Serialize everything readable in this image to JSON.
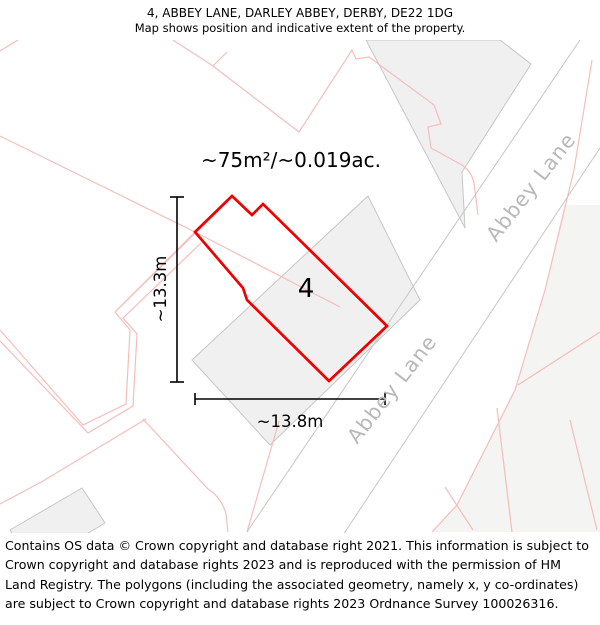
{
  "header": {
    "title": "4, ABBEY LANE, DARLEY ABBEY, DERBY, DE22 1DG",
    "subtitle": "Map shows position and indicative extent of the property."
  },
  "map": {
    "area_label": "~75m²/~0.019ac.",
    "plot_number": "4",
    "width_label": "~13.8m",
    "height_label": "~13.3m",
    "road_labels": {
      "upper": "Abbey Lane",
      "lower": "Abbey Lane"
    },
    "colors": {
      "property_outline": "#ee0000",
      "parcel_line": "#f5bdba",
      "building_fill": "#f0f0f0",
      "building_stroke": "#c6c6c6",
      "parcel_fill": "#f4f4f3",
      "road_edge": "#c6c6c6",
      "road_label": "#b8b8b8",
      "dimension": "#000000",
      "text": "#000000"
    }
  },
  "footer": {
    "attribution": "Contains OS data © Crown copyright and database right 2021. This information is subject to Crown copyright and database rights 2023 and is reproduced with the permission of HM Land Registry. The polygons (including the associated geometry, namely x, y co-ordinates) are subject to Crown copyright and database rights 2023 Ordnance Survey 100026316."
  }
}
